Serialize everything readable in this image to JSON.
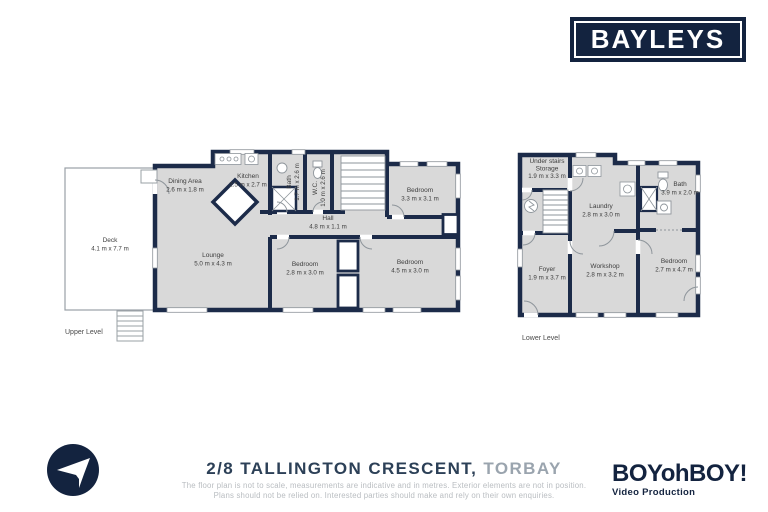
{
  "brand": {
    "bayleys_logo": "BAYLEYS",
    "boyohboy_logo": "BOYohBOY!",
    "boyohboy_sub": "Video Production"
  },
  "colors": {
    "wall_navy": "#1c2b49",
    "room_fill": "#d9d9d9",
    "logo_navy": "#13233f",
    "address_navy": "#2c4057",
    "suburb_gray": "#9aa4ae",
    "disclaimer_gray": "#b9bdc1"
  },
  "icons": {
    "sender": "paper-plane-icon",
    "plan_symbols": [
      "stairs",
      "shower",
      "toilet",
      "basin",
      "electrical-panel",
      "door-arc",
      "window"
    ]
  },
  "footer": {
    "address_main": "2/8 TALLINGTON CRESCENT,",
    "address_suburb": "TORBAY",
    "disclaimer_line1": "The floor plan is not to scale, measurements are indicative and in metres. Exterior elements are not in position.",
    "disclaimer_line2": "Plans should not be relied on. Interested parties should make and rely on their own enquiries."
  },
  "upper_level": {
    "caption": "Upper Level",
    "rooms": {
      "deck": {
        "name": "Deck",
        "dims": "4.1 m x 7.7 m"
      },
      "dining": {
        "name": "Dining Area",
        "dims": "2.6 m x 1.8 m"
      },
      "kitchen": {
        "name": "Kitchen",
        "dims": "2.5 m x 2.7 m"
      },
      "bath": {
        "name": "Bath",
        "dims": "1.7 m x 2.6 m"
      },
      "wc": {
        "name": "W.C.",
        "dims": "1.0 m x 2.6 m"
      },
      "hall": {
        "name": "Hall",
        "dims": "4.8 m x 1.1 m"
      },
      "lounge": {
        "name": "Lounge",
        "dims": "5.0 m x 4.3 m"
      },
      "bedroom_top": {
        "name": "Bedroom",
        "dims": "3.3 m x 3.1 m"
      },
      "bedroom_mid": {
        "name": "Bedroom",
        "dims": "2.8 m x 3.0 m"
      },
      "bedroom_right": {
        "name": "Bedroom",
        "dims": "4.5 m x 3.0 m"
      }
    }
  },
  "lower_level": {
    "caption": "Lower Level",
    "rooms": {
      "storage": {
        "name_line1": "Under stairs",
        "name_line2": "Storage",
        "dims": "1.9 m x 3.3 m"
      },
      "laundry": {
        "name": "Laundry",
        "dims": "2.8 m x 3.0 m"
      },
      "bath": {
        "name": "Bath",
        "dims": "3.9 m x 2.0 m"
      },
      "foyer": {
        "name": "Foyer",
        "dims": "1.9 m x 3.7 m"
      },
      "workshop": {
        "name": "Workshop",
        "dims": "2.8 m x 3.2 m"
      },
      "bedroom": {
        "name": "Bedroom",
        "dims": "2.7 m x 4.7 m"
      }
    }
  }
}
